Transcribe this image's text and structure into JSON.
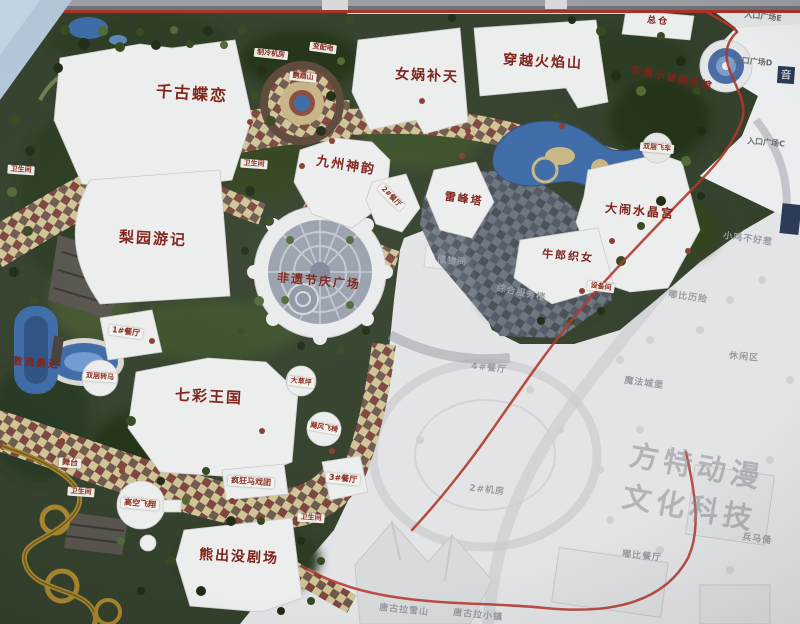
{
  "labels": {
    "qiangu_dielian": "千古蝶恋",
    "nvwa_butian": "女娲补天",
    "chuanyue_huoyanshan": "穿越火焰山",
    "zongcang": "总仓",
    "jiuzhou_shenyun": "九州神韵",
    "liyuan_youji": "梨园游记",
    "feiyi_jieqing_guangchang": "非遗节庆广场",
    "leifengta": "雷峰塔",
    "danao_shuijinggong": "大闹水晶宫",
    "niulang_zhinv": "牛郎织女",
    "qicai_wangguo": "七彩王国",
    "xiongchumo_juchang": "熊出没剧场",
    "jiliu_yongjin": "激流勇进",
    "feiyi_xiaozhen": "非遗小镇展示馆",
    "zhileng_jifang": "制冷机房",
    "bianpeidian": "变配电",
    "yingwushan": "鹦鹉山",
    "weishengjian": "卫生间",
    "canting_1": "1#餐厅",
    "canting_2": "2#餐厅",
    "canting_3": "3#餐厅",
    "canting_4": "4#餐厅",
    "shuangceng_zhuanma": "双层转马",
    "dacaoping": "大草坪",
    "jufeng_feiyi": "飓风飞椅",
    "fengkuang_maxituan": "疯狂马戏团",
    "gaokong_feixiang": "高空飞翔",
    "wutai": "舞台",
    "shuangceng_feiche": "双层飞车",
    "shebeijian": "设备间",
    "jifang_2": "2#机房",
    "chuwujian": "储物间",
    "zonghe_fuwulou": "综合服务楼",
    "xiaoji_buhaore": "小鸡不好惹",
    "dubi_lixian": "嘟比历险",
    "xiuxianqu": "休闲区",
    "mofa_chengbao": "魔法城堡",
    "tanggula_xueshan": "唐古拉雪山",
    "tanggula_xiaozhen": "唐古拉小镇",
    "dubi_canting": "嘟比餐厅",
    "bingmayong": "兵马俑",
    "rukou_e": "入口广场E",
    "rukou_d": "入口广场D",
    "rukou_c": "入口广场C",
    "yin": "音",
    "watermark": "方特动漫文化科技"
  },
  "colors": {
    "label_red": "#7e2118",
    "tag_red": "#8a2a1e",
    "faded_text": "#979ca4",
    "foliage_green": "#33402b",
    "water_blue": "#3c6aa6",
    "path_cream": "#cfc396",
    "path_maroon": "#7c463e",
    "road_red": "#b2352a",
    "coaster_gold": "#a5842f",
    "sign_navy": "#2b3a56",
    "sky_blue": "#b1c6d8"
  }
}
